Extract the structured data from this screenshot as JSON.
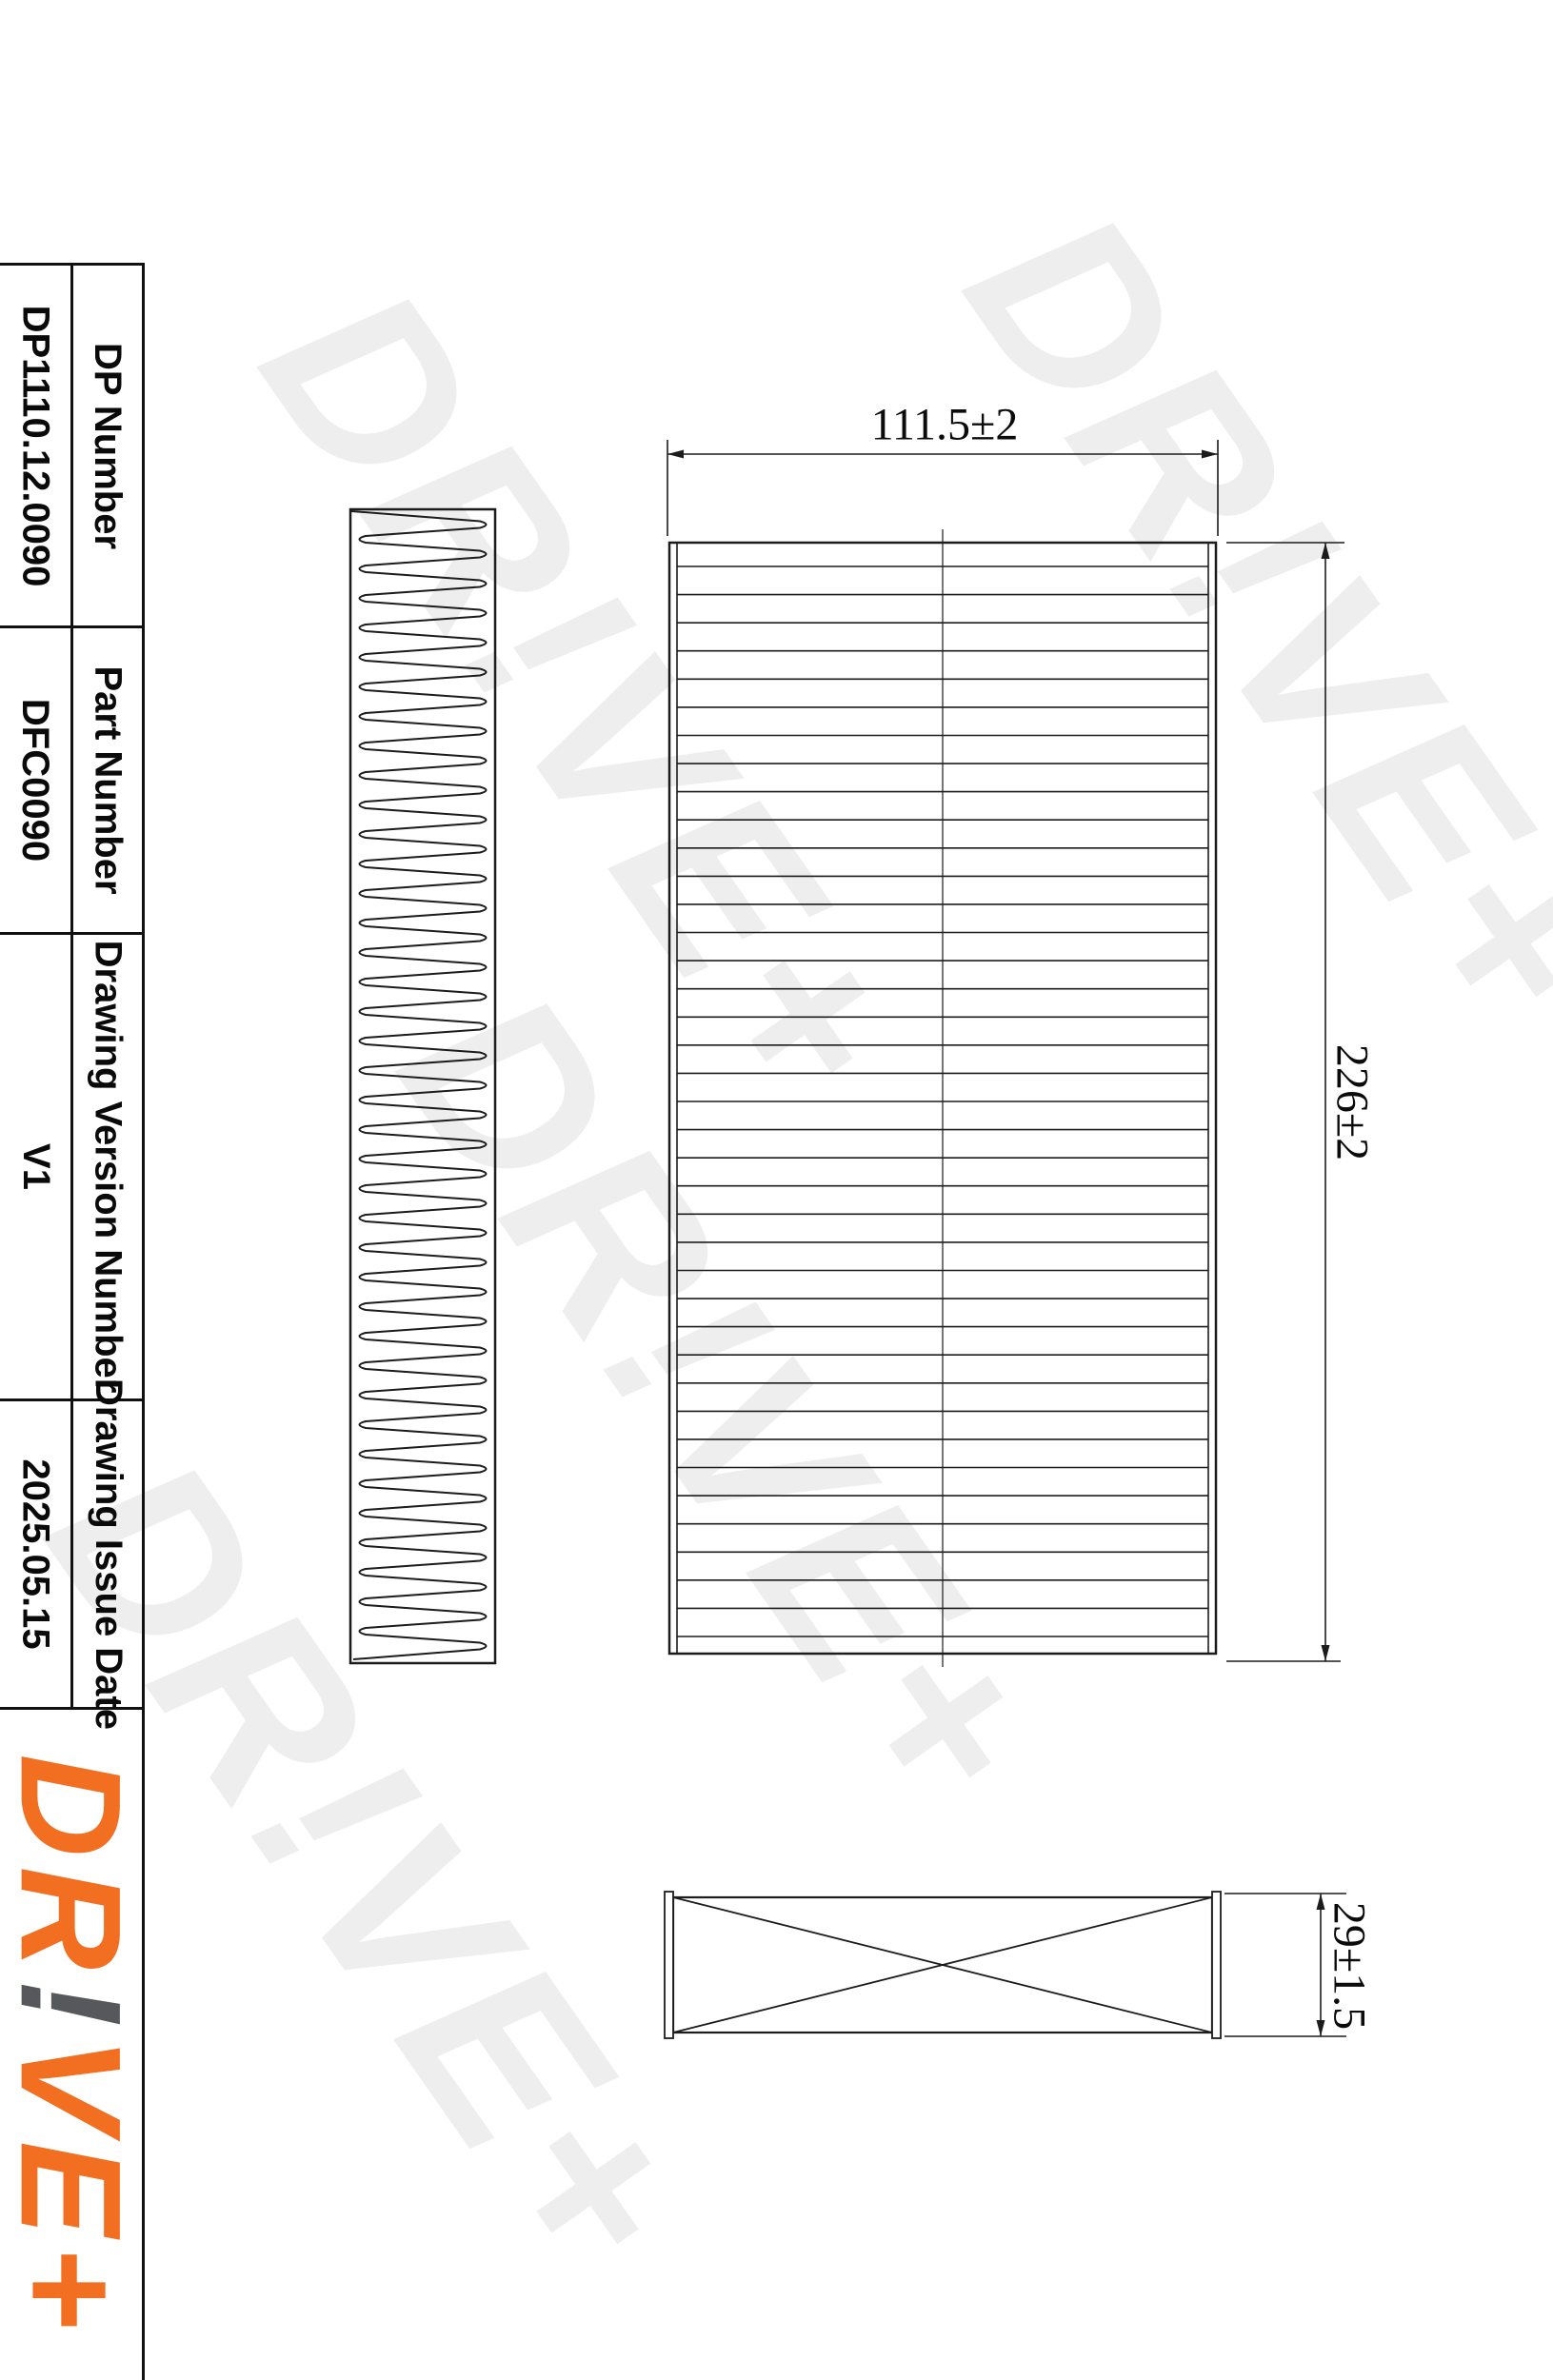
{
  "title_block": {
    "rows": [
      {
        "label": "DP Number",
        "value": "DP1110.12.0090"
      },
      {
        "label": "Part Number",
        "value": "DFC0090"
      },
      {
        "label": "Drawing Version Number",
        "value": "V1"
      },
      {
        "label": "Drawing Issue Date",
        "value": "2025.05.15"
      }
    ]
  },
  "dimensions": {
    "width": "111.5±2",
    "height": "226±2",
    "thickness": "29±1.5"
  },
  "brand": {
    "logo_prefix": "DR",
    "logo_bang": "!",
    "logo_suffix": "VE+",
    "watermark": "DR!VE+",
    "orange": "#F26E21",
    "gray": "#57585B",
    "watermark_color": "#eeeeee"
  }
}
